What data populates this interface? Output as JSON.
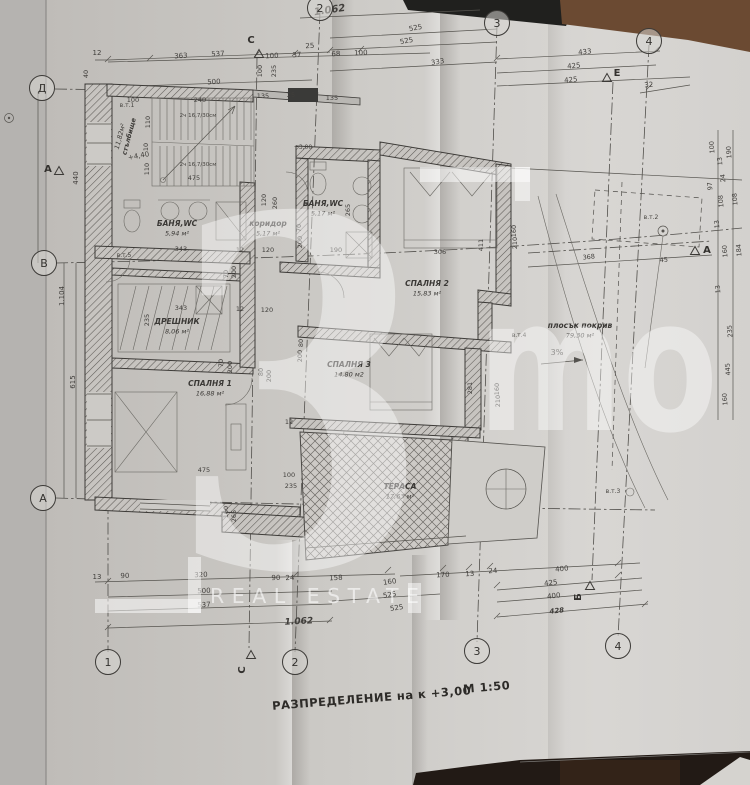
{
  "photo": {
    "paper": "#cbc8c4",
    "paper_left_strip": "#b5b3b0",
    "table_black": "#20201e",
    "table_brown": "#6b4a32",
    "table_bottom": "#221a15",
    "corner_light": "#d5d3cf"
  },
  "title": {
    "text": "РАЗПРЕДЕЛЕНИЕ на к +3,00",
    "scale": "М 1:50"
  },
  "watermark": {
    "big": "3",
    "mo": "mo",
    "subtitle": "REAL ESTATE"
  },
  "grid_markers": {
    "circles": [
      {
        "l": "2",
        "x": 320,
        "y": 8
      },
      {
        "l": "3",
        "x": 497,
        "y": 23
      },
      {
        "l": "4",
        "x": 649,
        "y": 41
      },
      {
        "l": "1",
        "x": 108,
        "y": 662
      },
      {
        "l": "2",
        "x": 295,
        "y": 662
      },
      {
        "l": "3",
        "x": 477,
        "y": 651
      },
      {
        "l": "4",
        "x": 618,
        "y": 646
      },
      {
        "l": "Д",
        "x": 42,
        "y": 88
      },
      {
        "l": "В",
        "x": 44,
        "y": 263
      },
      {
        "l": "А",
        "x": 43,
        "y": 498
      }
    ],
    "triangles": [
      {
        "l": "С",
        "lx": 251,
        "ly": 43,
        "tx": 259,
        "ty": 54,
        "rot": 0
      },
      {
        "l": "С",
        "lx": 245,
        "ly": 670,
        "tx": 251,
        "ty": 655,
        "rot": -90
      },
      {
        "l": "А",
        "lx": 707,
        "ly": 253,
        "tx": 695,
        "ty": 251,
        "rot": 0
      },
      {
        "l": "Б",
        "lx": 581,
        "ly": 597,
        "tx": 590,
        "ty": 586,
        "rot": -90
      },
      {
        "l": "А",
        "lx": 48,
        "ly": 172,
        "tx": 59,
        "ty": 171,
        "rot": 0
      },
      {
        "l": "Е",
        "lx": 617,
        "ly": 76,
        "tx": 607,
        "ty": 78,
        "rot": 0
      }
    ]
  },
  "rooms": [
    {
      "name": "стълбище",
      "area": "11,82м²",
      "x": 131,
      "y": 137,
      "r": -75,
      "s": 6.5
    },
    {
      "name": "БАНЯ,WC",
      "area": "5,94 м²",
      "x": 177,
      "y": 226
    },
    {
      "name": "БАНЯ,WC",
      "area": "5,17 м²",
      "x": 323,
      "y": 206
    },
    {
      "name": "коридор",
      "area": "5,17 м²",
      "x": 268,
      "y": 226
    },
    {
      "name": "СПАЛНЯ 2",
      "area": "15,83 м²",
      "x": 427,
      "y": 286
    },
    {
      "name": "ДРЕШНИК",
      "area": "8,06 м²",
      "x": 177,
      "y": 324
    },
    {
      "name": "СПАЛНЯ 1",
      "area": "16,88 м²",
      "x": 210,
      "y": 386
    },
    {
      "name": "СПАЛНЯ 3",
      "area": "14,80 м2",
      "x": 349,
      "y": 367
    },
    {
      "name": "ТЕРАСА",
      "area": "17,63 м²",
      "x": 400,
      "y": 489
    },
    {
      "name": "плосък покрив",
      "area": "79,30 м²",
      "x": 580,
      "y": 328
    }
  ],
  "annotations": [
    {
      "t": "+4,40",
      "x": 139,
      "y": 158,
      "r": -10,
      "s": 7
    },
    {
      "t": "+3,00",
      "x": 303,
      "y": 149,
      "s": 6
    },
    {
      "t": "в.т.1",
      "x": 127,
      "y": 107,
      "s": 6
    },
    {
      "t": "в.т.5",
      "x": 124,
      "y": 257,
      "s": 6
    },
    {
      "t": "в.т.4",
      "x": 519,
      "y": 337,
      "s": 6
    },
    {
      "t": "в.т.2",
      "x": 651,
      "y": 219,
      "s": 6
    },
    {
      "t": "в.т.3",
      "x": 613,
      "y": 493,
      "s": 6
    },
    {
      "t": "3%",
      "x": 557,
      "y": 355,
      "s": 8
    },
    {
      "t": "2ч 16,7/30см",
      "x": 198,
      "y": 117,
      "s": 5.5
    },
    {
      "t": "2ч 16,7/30см",
      "x": 198,
      "y": 166,
      "s": 5.5
    }
  ],
  "dims": [
    {
      "t": "1.062",
      "x": 330,
      "y": 13,
      "r": -8,
      "b": 1,
      "s": 10
    },
    {
      "t": "537",
      "x": 218,
      "y": 56,
      "r": -3
    },
    {
      "t": "500",
      "x": 214,
      "y": 84,
      "r": -3
    },
    {
      "t": "363",
      "x": 181,
      "y": 58,
      "r": -3
    },
    {
      "t": "12",
      "x": 97,
      "y": 55
    },
    {
      "t": "100",
      "x": 272,
      "y": 58,
      "r": -3
    },
    {
      "t": "37",
      "x": 297,
      "y": 57,
      "r": -3
    },
    {
      "t": "25",
      "x": 310,
      "y": 48,
      "r": -3
    },
    {
      "t": "68",
      "x": 336,
      "y": 56,
      "r": -3
    },
    {
      "t": "100",
      "x": 361,
      "y": 55,
      "r": -3
    },
    {
      "t": "525",
      "x": 416,
      "y": 30,
      "r": -11
    },
    {
      "t": "525",
      "x": 407,
      "y": 43,
      "r": -11
    },
    {
      "t": "333",
      "x": 438,
      "y": 64,
      "r": -9
    },
    {
      "t": "433",
      "x": 585,
      "y": 54,
      "r": -5
    },
    {
      "t": "425",
      "x": 574,
      "y": 68,
      "r": -5
    },
    {
      "t": "425",
      "x": 571,
      "y": 82,
      "r": -5
    },
    {
      "t": "32",
      "x": 649,
      "y": 87,
      "r": -5
    },
    {
      "t": "40",
      "x": 88,
      "y": 74,
      "r": -90,
      "s": 6.5
    },
    {
      "t": "100",
      "x": 262,
      "y": 71,
      "r": -90,
      "s": 6.5
    },
    {
      "t": "235",
      "x": 276,
      "y": 71,
      "r": -90,
      "s": 6.5
    },
    {
      "t": "135",
      "x": 263,
      "y": 98,
      "s": 6.5
    },
    {
      "t": "25",
      "x": 291,
      "y": 97,
      "s": 6.5
    },
    {
      "t": "135",
      "x": 332,
      "y": 100,
      "s": 6.5
    },
    {
      "t": "100",
      "x": 133,
      "y": 102,
      "s": 6.5
    },
    {
      "t": "240",
      "x": 200,
      "y": 102,
      "s": 6.5
    },
    {
      "t": "475",
      "x": 194,
      "y": 180,
      "s": 6.5
    },
    {
      "t": "110",
      "x": 150,
      "y": 122,
      "r": -90,
      "s": 6.5
    },
    {
      "t": "10",
      "x": 148,
      "y": 147,
      "r": -90,
      "s": 6.5
    },
    {
      "t": "110",
      "x": 149,
      "y": 169,
      "r": -90,
      "s": 6.5
    },
    {
      "t": "440",
      "x": 78,
      "y": 178,
      "r": -90
    },
    {
      "t": "1.104",
      "x": 64,
      "y": 296,
      "r": -90
    },
    {
      "t": "615",
      "x": 75,
      "y": 382,
      "r": -90
    },
    {
      "t": "343",
      "x": 181,
      "y": 251,
      "s": 6.5
    },
    {
      "t": "12",
      "x": 240,
      "y": 252,
      "s": 6.5
    },
    {
      "t": "120",
      "x": 268,
      "y": 252,
      "s": 6.5
    },
    {
      "t": "343",
      "x": 181,
      "y": 310,
      "s": 6.5
    },
    {
      "t": "12",
      "x": 240,
      "y": 311,
      "s": 6.5
    },
    {
      "t": "120",
      "x": 267,
      "y": 312,
      "s": 6.5
    },
    {
      "t": "120",
      "x": 266,
      "y": 200,
      "r": -90,
      "s": 6.5
    },
    {
      "t": "260",
      "x": 277,
      "y": 203,
      "r": -90,
      "s": 6.5
    },
    {
      "t": "235",
      "x": 149,
      "y": 320,
      "r": -90,
      "s": 6.5
    },
    {
      "t": "70",
      "x": 228,
      "y": 274,
      "r": -90,
      "s": 6.5
    },
    {
      "t": "200",
      "x": 236,
      "y": 272,
      "r": -90,
      "s": 6.5
    },
    {
      "t": "70",
      "x": 301,
      "y": 228,
      "r": -90,
      "s": 6.5
    },
    {
      "t": "200",
      "x": 302,
      "y": 242,
      "r": -90,
      "s": 6.5
    },
    {
      "t": "80",
      "x": 303,
      "y": 343,
      "r": -90,
      "s": 6.5
    },
    {
      "t": "200",
      "x": 302,
      "y": 356,
      "r": -90,
      "s": 6.5
    },
    {
      "t": "70",
      "x": 223,
      "y": 363,
      "r": -90,
      "s": 6.5
    },
    {
      "t": "200",
      "x": 232,
      "y": 367,
      "r": -90,
      "s": 6.5
    },
    {
      "t": "80",
      "x": 263,
      "y": 372,
      "r": -90,
      "s": 6.5
    },
    {
      "t": "200",
      "x": 271,
      "y": 376,
      "r": -90,
      "s": 6.5
    },
    {
      "t": "265",
      "x": 350,
      "y": 210,
      "r": -90,
      "s": 6.5
    },
    {
      "t": "190",
      "x": 336,
      "y": 252,
      "s": 6.5
    },
    {
      "t": "306",
      "x": 440,
      "y": 254,
      "s": 6.5
    },
    {
      "t": "160",
      "x": 516,
      "y": 231,
      "r": -90,
      "s": 6.5
    },
    {
      "t": "210",
      "x": 517,
      "y": 243,
      "r": -90,
      "s": 6.5
    },
    {
      "t": "411",
      "x": 483,
      "y": 245,
      "r": -90,
      "s": 6.5
    },
    {
      "t": "281",
      "x": 472,
      "y": 388,
      "r": -90,
      "s": 6.5
    },
    {
      "t": "160",
      "x": 499,
      "y": 389,
      "r": -90,
      "s": 6.5
    },
    {
      "t": "210",
      "x": 500,
      "y": 401,
      "r": -90,
      "s": 6.5
    },
    {
      "t": "12",
      "x": 289,
      "y": 424,
      "s": 6.5
    },
    {
      "t": "100",
      "x": 289,
      "y": 477,
      "s": 6.5
    },
    {
      "t": "235",
      "x": 291,
      "y": 488,
      "s": 6.5
    },
    {
      "t": "475",
      "x": 204,
      "y": 472,
      "s": 6.5
    },
    {
      "t": "160",
      "x": 228,
      "y": 512,
      "r": -90,
      "s": 6.5
    },
    {
      "t": "265",
      "x": 236,
      "y": 516,
      "r": -90,
      "s": 6.5
    },
    {
      "t": "368",
      "x": 589,
      "y": 259,
      "r": -6,
      "s": 6.5
    },
    {
      "t": "45",
      "x": 664,
      "y": 262,
      "r": -6,
      "s": 6.5
    },
    {
      "t": "100",
      "x": 714,
      "y": 147,
      "r": -95,
      "s": 6.5
    },
    {
      "t": "190",
      "x": 731,
      "y": 152,
      "r": -95,
      "s": 6.5
    },
    {
      "t": "13",
      "x": 722,
      "y": 161,
      "r": -95,
      "s": 6.5
    },
    {
      "t": "24",
      "x": 725,
      "y": 178,
      "r": -95,
      "s": 6.5
    },
    {
      "t": "97",
      "x": 712,
      "y": 186,
      "r": -95,
      "s": 6.5
    },
    {
      "t": "108",
      "x": 723,
      "y": 201,
      "r": -95,
      "s": 6.5
    },
    {
      "t": "108",
      "x": 737,
      "y": 199,
      "r": -95,
      "s": 6.5
    },
    {
      "t": "13",
      "x": 719,
      "y": 224,
      "r": -95,
      "s": 6.5
    },
    {
      "t": "160",
      "x": 727,
      "y": 251,
      "r": -95,
      "s": 6.5
    },
    {
      "t": "184",
      "x": 741,
      "y": 250,
      "r": -95,
      "s": 6.5
    },
    {
      "t": "13",
      "x": 720,
      "y": 289,
      "r": -95,
      "s": 6.5
    },
    {
      "t": "235",
      "x": 732,
      "y": 331,
      "r": -95,
      "s": 6.5
    },
    {
      "t": "445",
      "x": 730,
      "y": 369,
      "r": -95,
      "s": 6.5
    },
    {
      "t": "160",
      "x": 727,
      "y": 399,
      "r": -95,
      "s": 6.5
    },
    {
      "t": "13",
      "x": 97,
      "y": 579
    },
    {
      "t": "90",
      "x": 125,
      "y": 578,
      "r": -2
    },
    {
      "t": "320",
      "x": 201,
      "y": 577,
      "r": -2
    },
    {
      "t": "90",
      "x": 276,
      "y": 580,
      "r": -2
    },
    {
      "t": "24",
      "x": 290,
      "y": 580,
      "r": -2
    },
    {
      "t": "158",
      "x": 336,
      "y": 580,
      "r": -3
    },
    {
      "t": "160",
      "x": 390,
      "y": 584,
      "r": -8
    },
    {
      "t": "170",
      "x": 443,
      "y": 577,
      "r": -3
    },
    {
      "t": "13",
      "x": 470,
      "y": 576,
      "r": -3
    },
    {
      "t": "24",
      "x": 493,
      "y": 573,
      "r": -3
    },
    {
      "t": "400",
      "x": 562,
      "y": 571,
      "r": -5
    },
    {
      "t": "500",
      "x": 204,
      "y": 593,
      "r": -2
    },
    {
      "t": "537",
      "x": 204,
      "y": 607,
      "r": -2
    },
    {
      "t": "525",
      "x": 390,
      "y": 597,
      "r": -9
    },
    {
      "t": "525",
      "x": 397,
      "y": 610,
      "r": -9
    },
    {
      "t": "425",
      "x": 551,
      "y": 585,
      "r": -6
    },
    {
      "t": "400",
      "x": 554,
      "y": 598,
      "r": -6
    },
    {
      "t": "428",
      "x": 557,
      "y": 613,
      "r": -6,
      "b": 1
    },
    {
      "t": "1.062",
      "x": 299,
      "y": 624,
      "r": -3,
      "b": 1,
      "s": 9
    }
  ]
}
